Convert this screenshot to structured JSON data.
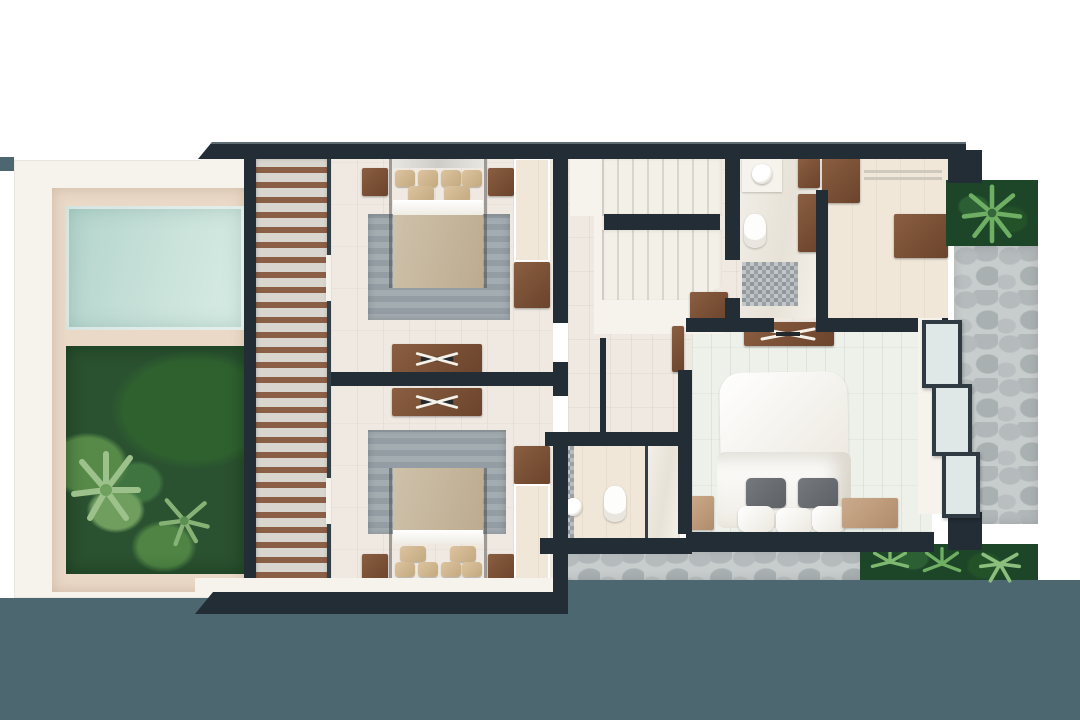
{
  "scene": {
    "kind": "architectural-floor-plan",
    "view": "top-down upper-level render of a villa",
    "visible_text": "",
    "areas": [
      "plunge-pool",
      "roof-garden",
      "timber-slat-walkway",
      "bedroom-1",
      "bedroom-2",
      "shared-bathroom",
      "stair-hall",
      "u-shaped-staircase",
      "master-bathroom",
      "walk-in-closet",
      "master-bedroom",
      "stone-terrace",
      "planter-beds",
      "water-feature"
    ]
  },
  "palette": {
    "wall": "#232d35",
    "white": "#f6f2ec",
    "floorTile": "#efe9e2",
    "floorMaster": "#eef0ea",
    "deck": "#ead9c7",
    "gardenDark": "#2a5130",
    "woodMid": "#8a5f46",
    "water": "#4c6770",
    "glass": "#dfe8e6",
    "frame": "#2f3a42",
    "plantBed": "#1d4527"
  }
}
